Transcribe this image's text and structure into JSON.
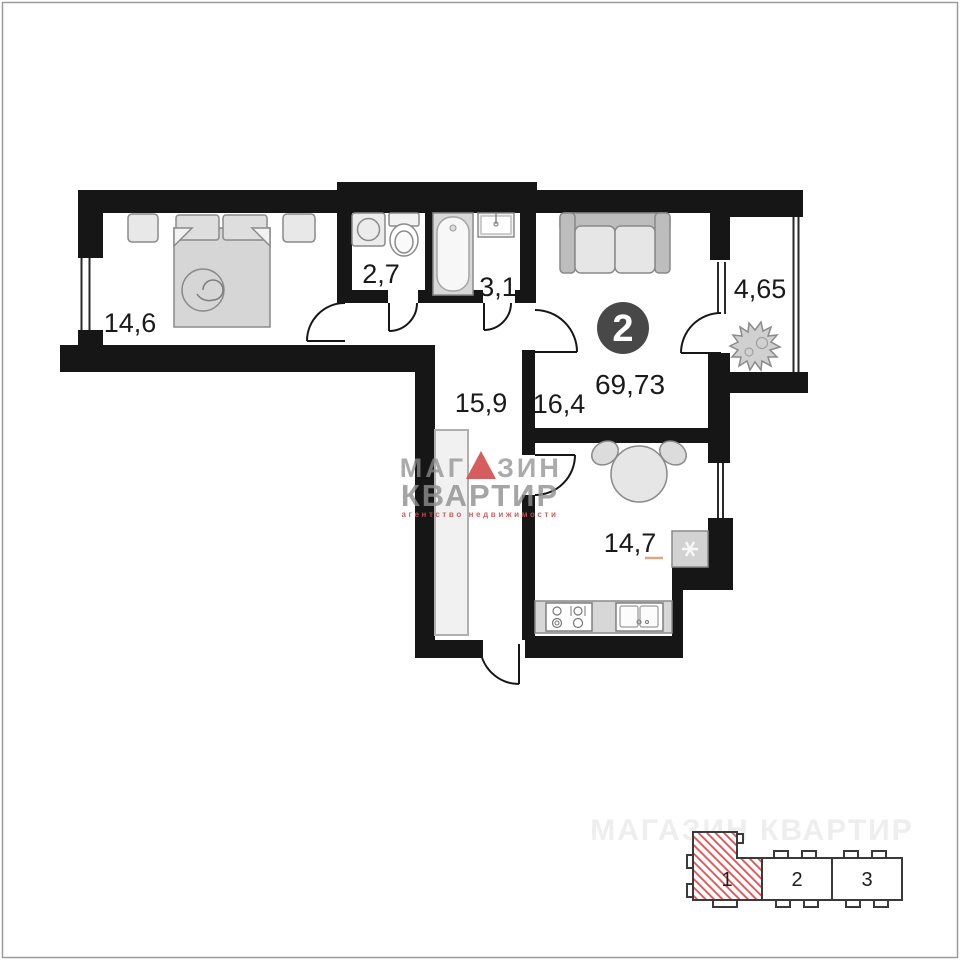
{
  "page": {
    "background": "#ffffff",
    "border_color": "#9b9b9b"
  },
  "plan": {
    "badge": {
      "value": "2",
      "bg": "#484848",
      "text_color": "#ffffff"
    },
    "total_area": "69,73",
    "rooms": [
      {
        "id": "bedroom",
        "area": "14,6"
      },
      {
        "id": "bathroom",
        "area": "2,7"
      },
      {
        "id": "bath",
        "area": "3,1"
      },
      {
        "id": "hallway",
        "area": "15,9"
      },
      {
        "id": "living-room",
        "area": "16,4"
      },
      {
        "id": "balcony",
        "area": "4,65"
      },
      {
        "id": "kitchen",
        "area": "14,7"
      }
    ],
    "colors": {
      "wall": "#161616",
      "kitchen_underline": "#d9a97e"
    }
  },
  "watermark": {
    "brand_left": "МАГ",
    "brand_right": "ЗИН",
    "brand_line2": "КВАРТИР",
    "tagline": "агентство недвижимости",
    "letters_color": "#8f8f8f",
    "triangle_color": "#d14b4b",
    "tagline_color": "#c7504f"
  },
  "ghost_watermark": {
    "text": "МАГАЗИН КВАРТИР"
  },
  "building_plan": {
    "outline_color": "#3a3a3a",
    "hatch_color": "#e34c4c",
    "sections": [
      {
        "label": "1",
        "highlighted": true
      },
      {
        "label": "2",
        "highlighted": false
      },
      {
        "label": "3",
        "highlighted": false
      }
    ]
  }
}
